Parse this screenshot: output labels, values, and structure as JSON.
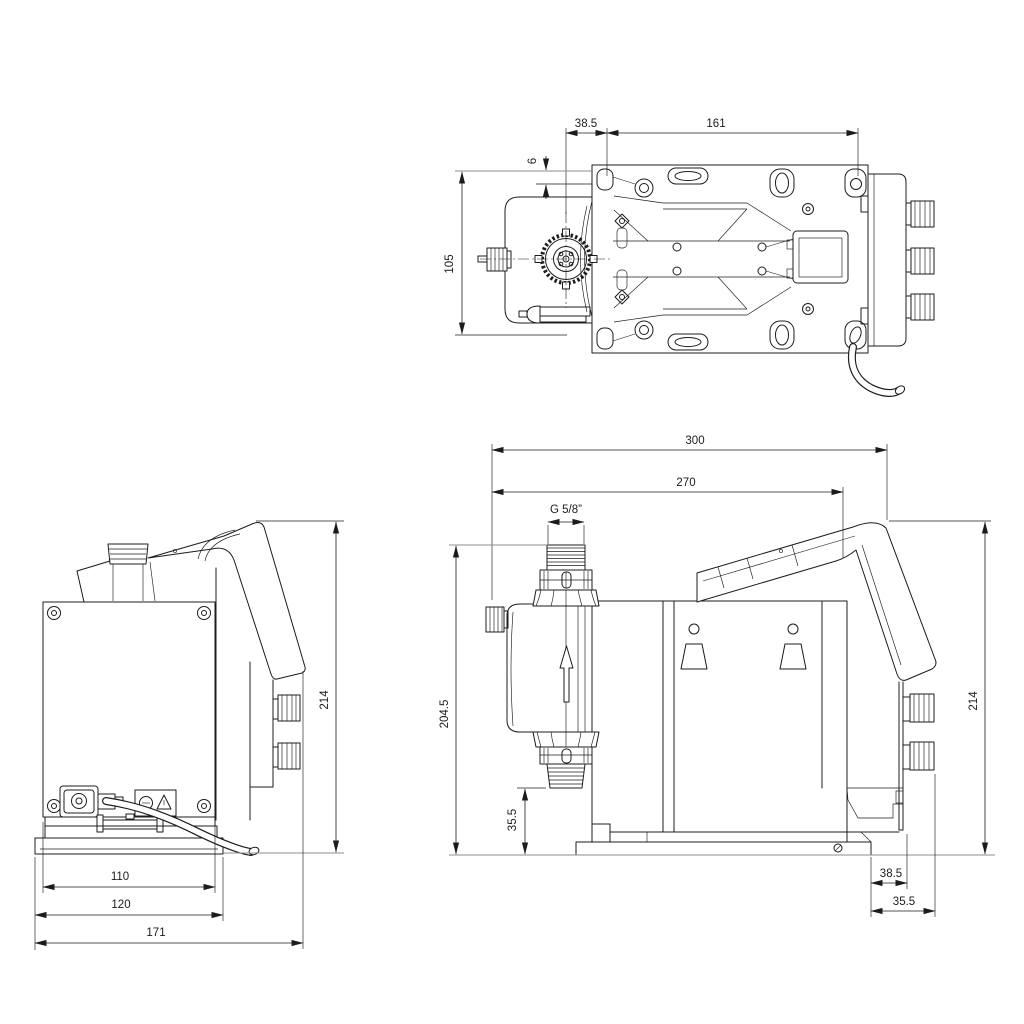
{
  "views": {
    "top": {
      "label": "top-view",
      "dims": {
        "offset_back": "38.5",
        "hole_spacing": "161",
        "edge_offset": "6",
        "width": "105"
      }
    },
    "back": {
      "label": "back-view",
      "dims": {
        "height": "214",
        "base_inner_width": "110",
        "base_width": "120",
        "depth": "171"
      }
    },
    "side": {
      "label": "side-view",
      "dims": {
        "depth_total": "300",
        "depth_to_panel": "270",
        "thread": "G 5/8”",
        "height_to_connection": "204.5",
        "suction_height": "35.5",
        "height": "214",
        "base_to_plug": "38.5",
        "rear_overhang": "35.5"
      }
    }
  },
  "colors": {
    "line": "#1c1c1c",
    "reference_line": "#8d8d8d",
    "background": "#ffffff"
  }
}
